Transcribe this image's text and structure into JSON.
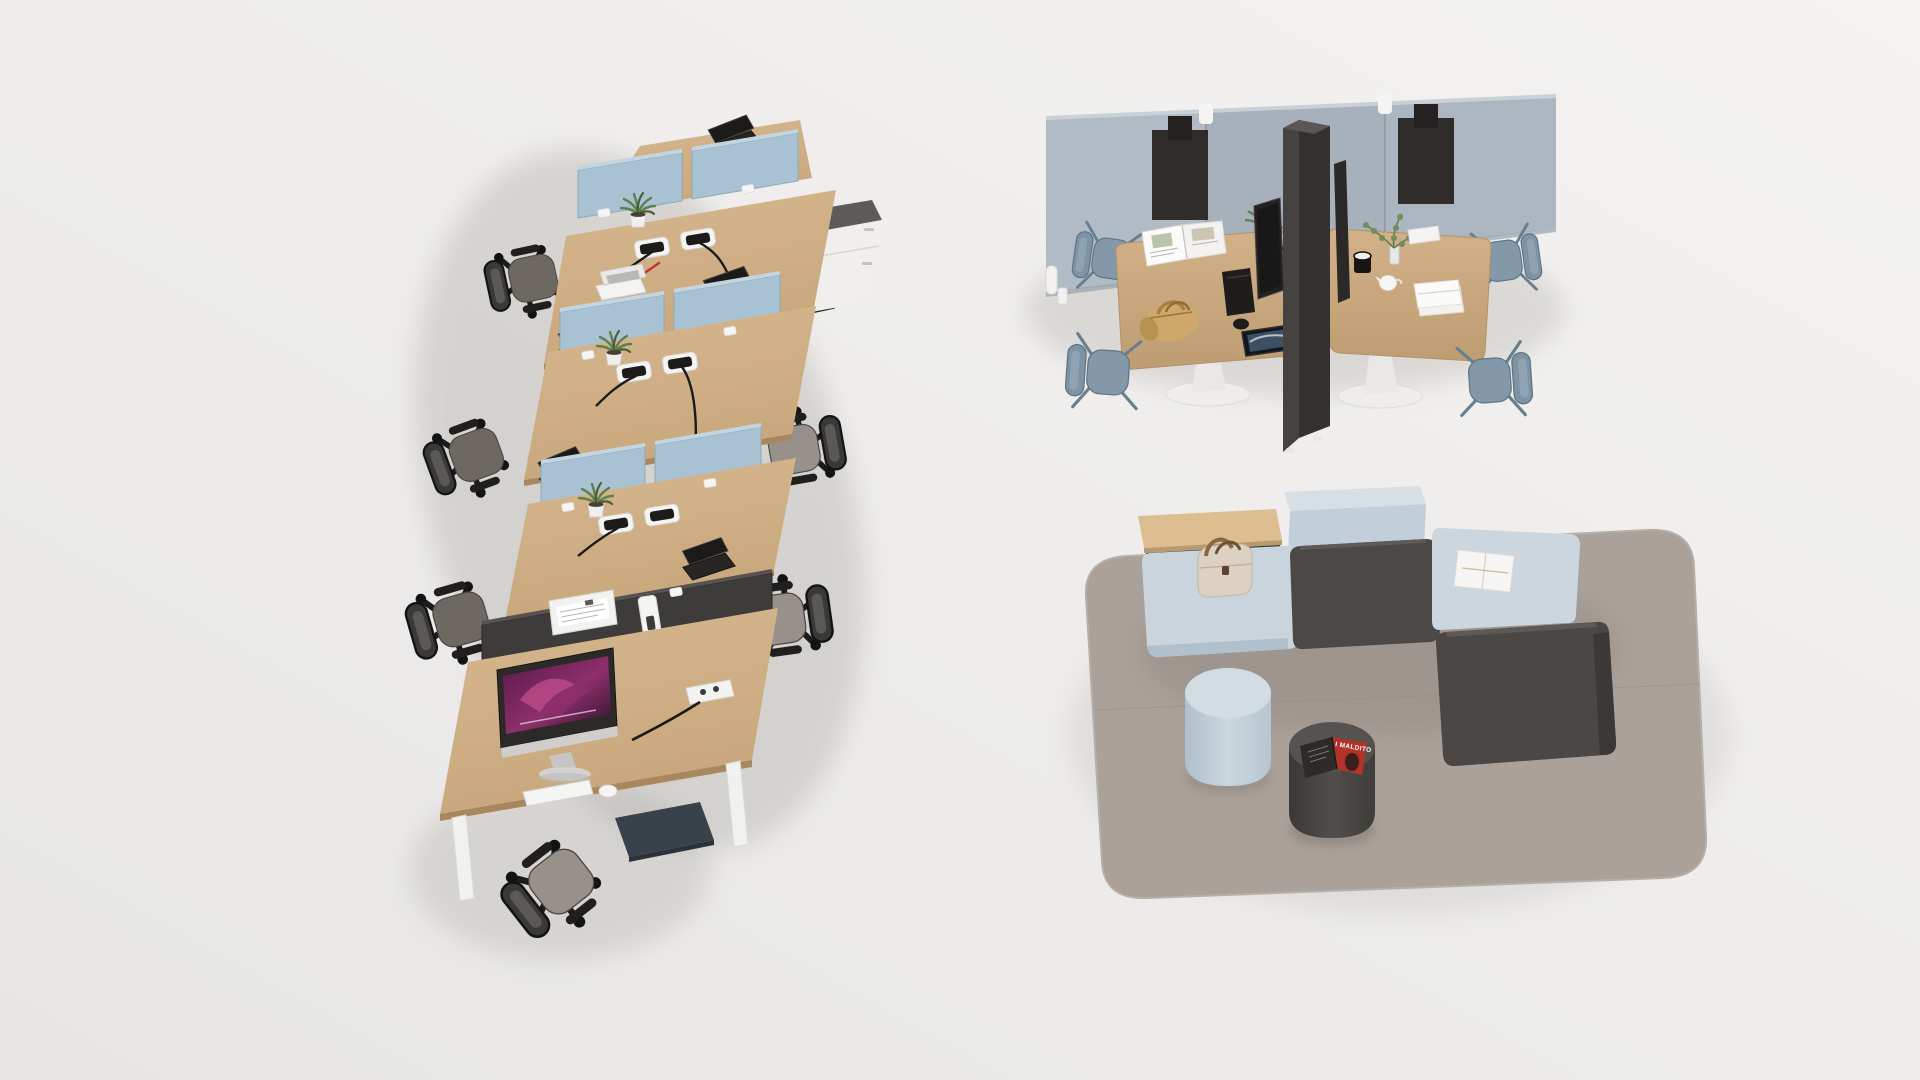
{
  "scene": {
    "description": "3D rendered isometric studio view of modern office furniture on a light grey floor",
    "areas": [
      "six person bench workstation cluster with acoustic screens",
      "acoustic meeting booth with two pedestal tables",
      "modular lounge landscape on a woven rug"
    ]
  },
  "palette": {
    "floorLight": "#f4f3f1",
    "floorDark": "#e7e6e4",
    "wood": "#c8a77c",
    "woodLight": "#d7b78f",
    "woodDark": "#ae8c63",
    "screenBlue": "#a9c2d3",
    "screenBlueTop": "#c3d5e1",
    "charcoal": "#3e3c3a",
    "charcoalLight": "#55524f",
    "wallA": "#b0bbc5",
    "wallB": "#a6b1bb",
    "wallSeam": "#8e9aa5",
    "pocketDark": "#2f2c29",
    "pedestalWhite": "#f0efee",
    "seatGreige": "#98908a",
    "seatWarmGrey": "#6e6862",
    "chairBlue": "#8398a8",
    "chairBlueDark": "#69808f",
    "white": "#fafaf9",
    "rug": "#aaa29a",
    "rugShadow": "#8a827a",
    "loungeBlue": "#c9d4dd",
    "loungeBlueDark": "#b4c2cf",
    "loungeCharcoal": "#4b4846",
    "bagTan": "#cfa76a",
    "handbagCream": "#ddd2c1",
    "strapBrown": "#8a6747",
    "magazineRed": "#b23329",
    "plantGreen": "#5f7f4d",
    "plantGreenDark": "#47623a",
    "screenPurpleA": "#58184a",
    "screenPurpleB": "#c4518e",
    "tabletScreen": "#3d4f63",
    "cableBlack": "#1a1a19"
  },
  "workstation_cluster": {
    "desks": 6,
    "divider_screens": "light blue felt desk screens",
    "end_screen": "charcoal felt screen with white paper trays",
    "monitor": "all-in-one computer with purple abstract wallpaper",
    "chairs": "black mesh task chairs with grey seats",
    "accessories": [
      "potted succulents",
      "laptops",
      "cable grommets",
      "power module",
      "white keyboard",
      "white mouse",
      "mobile pedestal"
    ]
  },
  "meeting_booth": {
    "wall": "light blue-grey acoustic panel wall",
    "wall_accessories": [
      "felt pocket",
      "felt pocket",
      "white panel hooks"
    ],
    "divider": "charcoal acoustic divider with back-to-back monitors",
    "tables": 2,
    "table_base": "white trumpet pedestal",
    "chairs": "four blue-grey shell chairs",
    "items_left_table": [
      "open magazine",
      "keyboard",
      "mouse",
      "tablet",
      "tan duffel bag",
      "potted plants"
    ],
    "items_right_table": [
      "trailing plant in glass vase",
      "black mug",
      "white creamer",
      "folded white towels",
      "white notepad"
    ]
  },
  "lounge": {
    "rug": "grey woven rug",
    "modules": [
      "light blue pouf with cream handbag",
      "wood side table",
      "light blue backrest block",
      "charcoal seat",
      "light blue bench with white book",
      "charcoal chaise"
    ],
    "poufs": [
      "light blue cylinder pouf",
      "charcoal cylinder pouf with open magazine"
    ],
    "magazine_title": "I MALDITO"
  }
}
